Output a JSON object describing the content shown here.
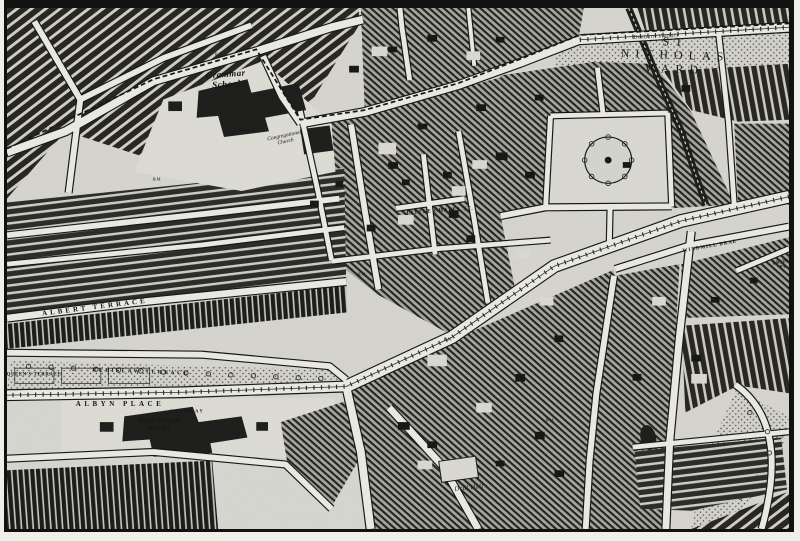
{
  "map": {
    "description": "Victorian town plan sheet",
    "ward_name": "ST NICHOLAS WARD",
    "labels": [
      {
        "id": "grammar-school",
        "text": "Grammar\nSchool",
        "x": 219,
        "y": 71,
        "size": 9,
        "rot": -4,
        "ls": 0.5,
        "cls": "lbl-name"
      },
      {
        "id": "statue",
        "text": "Statue",
        "x": 237,
        "y": 123,
        "size": 5,
        "rot": 0,
        "ls": 0,
        "cls": "lbl-tiny"
      },
      {
        "id": "congregational-church",
        "text": "Congregational\nChurch",
        "x": 278,
        "y": 131,
        "size": 5.5,
        "rot": -12,
        "ls": 0,
        "cls": "lbl-tiny"
      },
      {
        "id": "st-nicholas-ward",
        "text": "ST NICHOLAS WARD",
        "x": 668,
        "y": 48,
        "size": 12,
        "rot": 2,
        "ls": 6,
        "cls": "lbl-ward"
      },
      {
        "id": "denburn-viaduct",
        "text": "Denburn Viaduct",
        "x": 649,
        "y": 29,
        "size": 5.5,
        "rot": -2,
        "ls": 0.5,
        "cls": "lbl-tiny"
      },
      {
        "id": "little-chapel-st",
        "text": "LITTLE CHAPEL ST.",
        "x": 433,
        "y": 203,
        "size": 5.5,
        "rot": -4,
        "ls": 0.8,
        "cls": "lbl-street"
      },
      {
        "id": "albert-terrace",
        "text": "ALBERT TERRACE",
        "x": 88,
        "y": 300,
        "size": 7,
        "rot": -7,
        "ls": 3,
        "cls": "lbl-street"
      },
      {
        "id": "queens-terrace",
        "text": "QUEEN'S TERRACE",
        "x": 27,
        "y": 367,
        "size": 4.8,
        "rot": 0,
        "ls": 0.6,
        "cls": "lbl-street"
      },
      {
        "id": "rubislaw-terrace",
        "text": "RUBISLAW TERRACE",
        "x": 134,
        "y": 364,
        "size": 5.5,
        "rot": 2,
        "ls": 2.5,
        "cls": "lbl-street"
      },
      {
        "id": "albyn-place",
        "text": "ALBYN PLACE",
        "x": 113,
        "y": 397,
        "size": 7,
        "rot": 0,
        "ls": 3.5,
        "cls": "lbl-street"
      },
      {
        "id": "tramway",
        "text": "TRAMWAY",
        "x": 180,
        "y": 403,
        "size": 4.5,
        "rot": -1,
        "ls": 1.5,
        "cls": "lbl-street"
      },
      {
        "id": "high-school",
        "text": "High School\n(Girls)",
        "x": 152,
        "y": 417,
        "size": 7.5,
        "rot": 0,
        "ls": 0.3,
        "cls": "lbl-name"
      },
      {
        "id": "windmill-brae",
        "text": "WINDMILL BRAE",
        "x": 703,
        "y": 239,
        "size": 5,
        "rot": -10,
        "ls": 1,
        "cls": "lbl-street"
      },
      {
        "id": "bridge-place",
        "text": "BRIDGE PL.",
        "x": 777,
        "y": 257,
        "size": 4.8,
        "rot": -10,
        "ls": 0.5,
        "cls": "lbl-street"
      },
      {
        "id": "drill-hall",
        "text": "Drill Hall",
        "x": 462,
        "y": 480,
        "size": 6.5,
        "rot": -6,
        "ls": 0.3,
        "cls": "lbl-tiny"
      },
      {
        "id": "bm-1",
        "text": "B.M.",
        "x": 212,
        "y": 46,
        "size": 4.5,
        "rot": 0,
        "ls": 0,
        "cls": "lbl-tiny"
      },
      {
        "id": "bm-2",
        "text": "B.M.",
        "x": 150,
        "y": 171,
        "size": 4.5,
        "rot": 0,
        "ls": 0,
        "cls": "lbl-tiny"
      },
      {
        "id": "bm-3",
        "text": "B.M.",
        "x": 355,
        "y": 266,
        "size": 4.5,
        "rot": 0,
        "ls": 0,
        "cls": "lbl-tiny"
      },
      {
        "id": "bm-4",
        "text": "B.M.",
        "x": 441,
        "y": 331,
        "size": 4.5,
        "rot": 0,
        "ls": 0,
        "cls": "lbl-tiny"
      },
      {
        "id": "bm-5",
        "text": "B.M.",
        "x": 543,
        "y": 412,
        "size": 4.5,
        "rot": 0,
        "ls": 0,
        "cls": "lbl-tiny"
      }
    ]
  },
  "palette": {
    "paper": "#d5d4ce",
    "paper_light": "#dcdbd4",
    "road": "#eae9e3",
    "ink": "#161615",
    "block_dark": "#1d1d1b"
  }
}
